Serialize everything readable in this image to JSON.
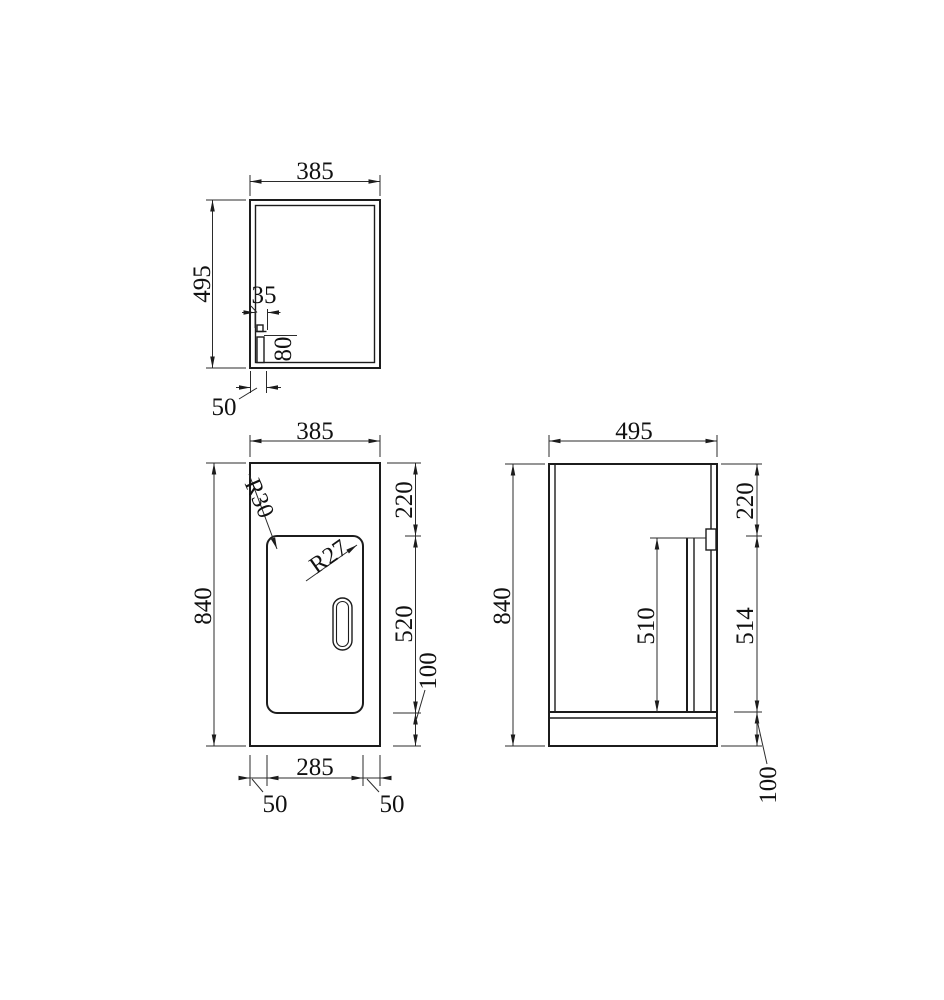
{
  "drawing": {
    "background": "#ffffff",
    "line_color": "#1c1c1c",
    "views": {
      "top": {
        "title": "top view",
        "width": "385",
        "depth": "495",
        "divider_width": "35",
        "divider_depth": "80",
        "divider_offset": "50"
      },
      "front": {
        "title": "front view",
        "width": "385",
        "height": "840",
        "door_top_gap": "220",
        "door_height": "520",
        "plinth_height": "100",
        "door_width": "285",
        "door_gap_left": "50",
        "door_gap_right": "50",
        "radius_top_left": "R30",
        "radius_top_right": "R27"
      },
      "side": {
        "title": "side view",
        "depth": "495",
        "height": "840",
        "door_top_gap": "220",
        "door_length": "510",
        "opening_height": "514",
        "plinth_height": "100"
      }
    }
  }
}
